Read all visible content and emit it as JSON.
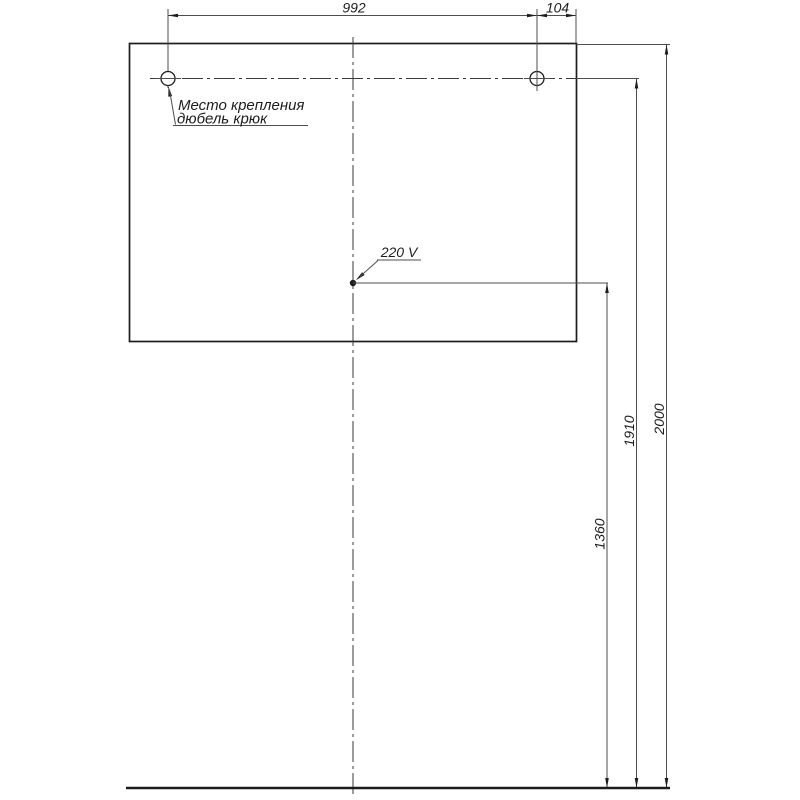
{
  "diagram": {
    "type": "installation-dimension-drawing",
    "dimensions": {
      "hole_spacing": "992",
      "hole_to_edge": "104",
      "socket_height": "1360",
      "hook_height": "1910",
      "top_height": "2000"
    },
    "labels": {
      "mount_point_line1": "Место крепления",
      "mount_point_line2": "дюбель крюк",
      "socket": "220 V"
    },
    "colors": {
      "outline": "#1d1d1d",
      "thin_line": "#4d4d4d",
      "background": "#ffffff"
    }
  }
}
